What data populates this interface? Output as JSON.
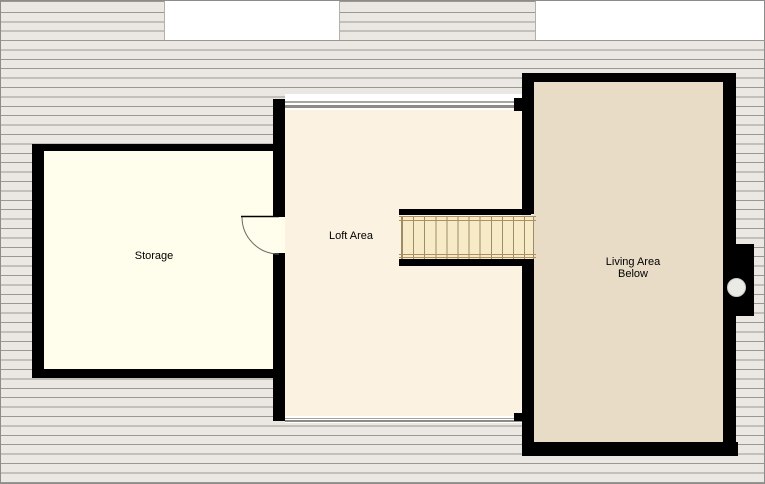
{
  "plan": {
    "type": "floor-plan",
    "rooms": {
      "storage": {
        "label": "Storage"
      },
      "loft": {
        "label": "Loft Area"
      },
      "living": {
        "label_line1": "Living Area",
        "label_line2": "Below"
      }
    },
    "features": {
      "staircase": {
        "treads": 12,
        "orientation": "horizontal"
      },
      "door": {
        "type": "swing",
        "location": "storage-to-loft"
      },
      "flue": {
        "shape": "circle",
        "location": "right-wall"
      }
    }
  },
  "colors": {
    "wall": "#000000",
    "storage_floor": "#FFFDEC",
    "loft_floor": "#FBF2E1",
    "living_floor": "#E8DCC6",
    "stair_tread": "#F7EAC6",
    "shingle_fill": "#EBE7E2",
    "shingle_line": "#9B9891"
  }
}
